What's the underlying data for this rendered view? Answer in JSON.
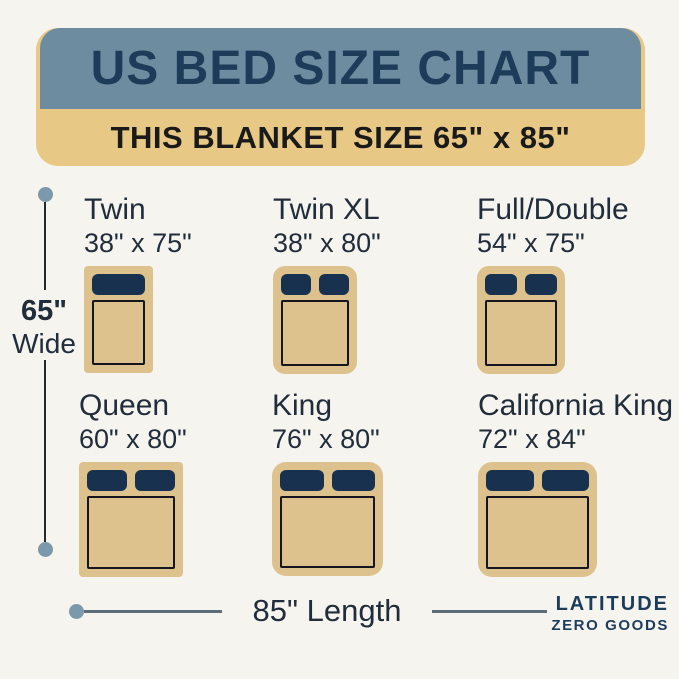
{
  "banner": {
    "title": "US BED SIZE CHART",
    "subtitle": "THIS BLANKET SIZE 65\" x 85\""
  },
  "beds": [
    {
      "name": "Twin",
      "size": "38\" x 75\"",
      "pillows": 1
    },
    {
      "name": "Twin XL",
      "size": "38\" x 80\"",
      "pillows": 2
    },
    {
      "name": "Full/Double",
      "size": "54\" x 75\"",
      "pillows": 2
    },
    {
      "name": "Queen",
      "size": "60\" x 80\"",
      "pillows": 2
    },
    {
      "name": "King",
      "size": "76\" x 80\"",
      "pillows": 2
    },
    {
      "name": "California King",
      "size": "72\" x 84\"",
      "pillows": 2
    }
  ],
  "dimensions": {
    "width_value": "65\"",
    "width_label": "Wide",
    "length_label": "85\" Length"
  },
  "brand": {
    "line1": "LATITUDE",
    "line2": "ZERO GOODS"
  },
  "colors": {
    "bg": "#f6f4ef",
    "slate": "#6d8c9f",
    "bannertan": "#e7c985",
    "bedtan": "#ddc28e",
    "navy": "#1d3c5a",
    "ink": "#212d3b",
    "black": "#1a1a1a",
    "pillow": "#17314f",
    "outline": "#15151f",
    "dimline": "#23292e",
    "dimlinegray": "#5d6d77",
    "dot": "#7b99aa"
  }
}
